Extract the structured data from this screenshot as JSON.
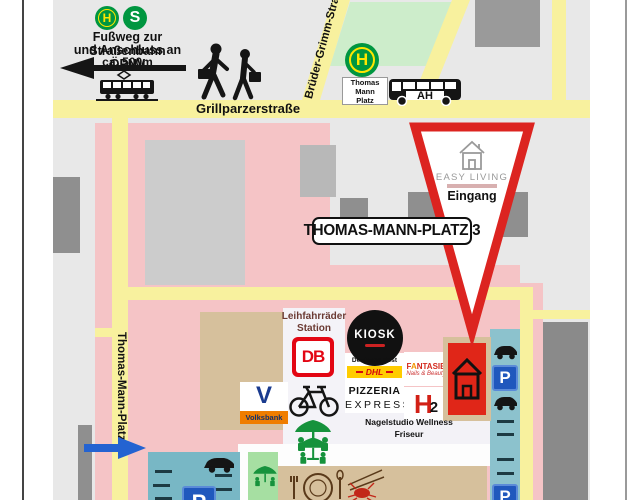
{
  "colors": {
    "street_yellow": "#f8f19e",
    "zone_pink": "#f5c4c6",
    "building_gray": "#8f8f8f",
    "building_light": "#cccccc",
    "park_green": "#cdedcb",
    "seating_green": "#a6dfa2",
    "parking_teal": "#8cc2cd",
    "sand_tan": "#d6c09c",
    "accent_red": "#dc2420",
    "transit_green": "#009640",
    "parking_blue": "#2058bd",
    "dhl_yellow": "#ffcc00",
    "db_red": "#e30613",
    "volksbank_orange": "#ef7d00",
    "volksbank_blue": "#12306b",
    "arrow_blue": "#2463d1"
  },
  "top_info": {
    "tram_symbol": "H",
    "sbahn_symbol": "S",
    "line1": "Fußweg zur Straßenbahn",
    "line2": "und Anschluss an ÖPNV",
    "line3": "ca. 500m"
  },
  "streets": {
    "grillparzer": "Grillparzerstraße",
    "bruedergrimm": "Brüder-Grimm-Straße",
    "thomasmann": "Thomas-Mann-Platz"
  },
  "bus_stop": {
    "symbol": "H",
    "name1": "Thomas",
    "name2": "Mann",
    "name3": "Platz",
    "bus_text": "AH"
  },
  "destination": {
    "address": "THOMAS-MANN-PLATZ 3",
    "brand": "EASY LIVING",
    "entrance": "Eingang"
  },
  "shops": {
    "bike1": "Leihfahrräder",
    "bike2": "Station",
    "db": "DB",
    "kiosk": "KIOSK",
    "post": "Deutsche Post",
    "dhl": "DHL",
    "pizza1": "PIZZERIA",
    "pizza2": "EXPRESS",
    "fant_f": "F",
    "fant_a": "A",
    "fant_rest": "NTASIE",
    "fant_sub": "Nails & Beauty",
    "h2_letter": "H",
    "h2_digit": "2",
    "svc1": "Nagelstudio Wellness",
    "svc2": "Friseur",
    "volksbank": "Volksbank"
  },
  "parking": {
    "p": "P"
  }
}
